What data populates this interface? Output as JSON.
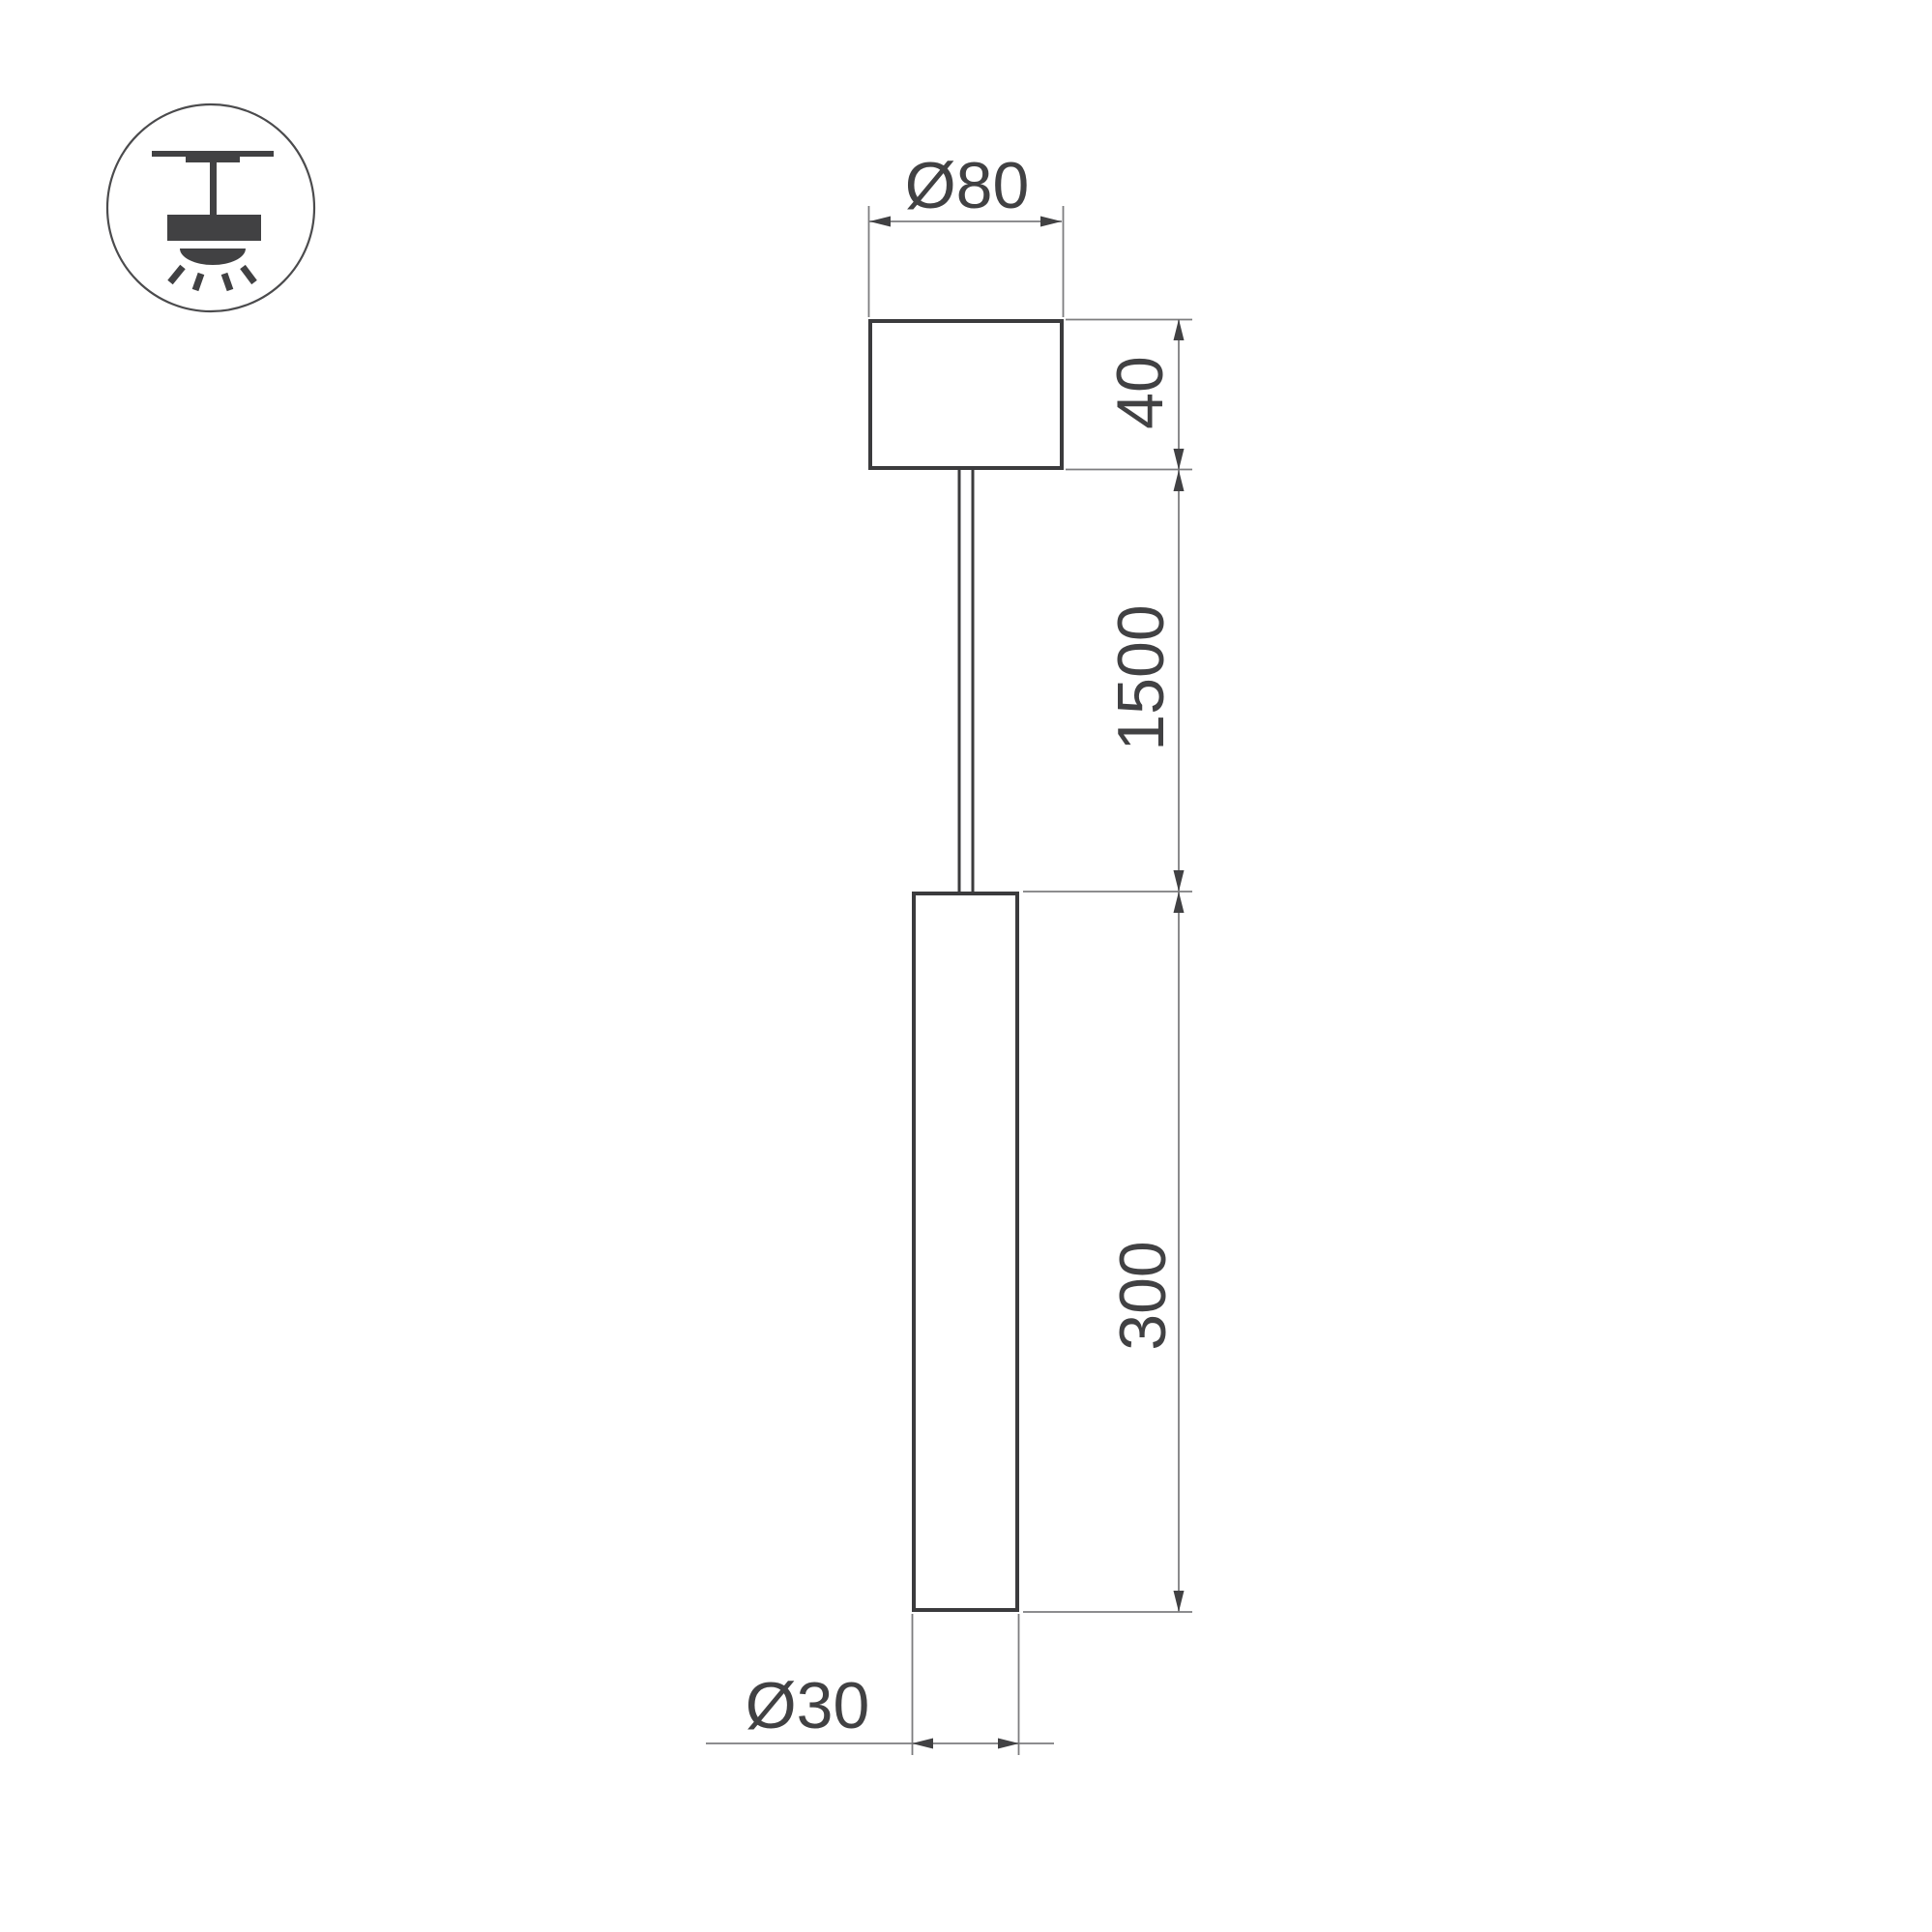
{
  "drawing": {
    "title": "pendant luminaire dimension drawing",
    "icon": "pendant-ceiling-mount",
    "labels": {
      "canopy_diameter": "Ø80",
      "canopy_height": "40",
      "suspension_length": "1500",
      "tube_length": "300",
      "tube_diameter": "Ø30"
    },
    "values_mm": {
      "canopy_diameter": 80,
      "canopy_height": 40,
      "suspension_length": 1500,
      "tube_length": 300,
      "tube_diameter": 30
    }
  },
  "colors": {
    "background": "#ffffff",
    "object_line": "#3b3b3d",
    "dimension_line": "#7d7d7f",
    "annotation": "#414143"
  }
}
